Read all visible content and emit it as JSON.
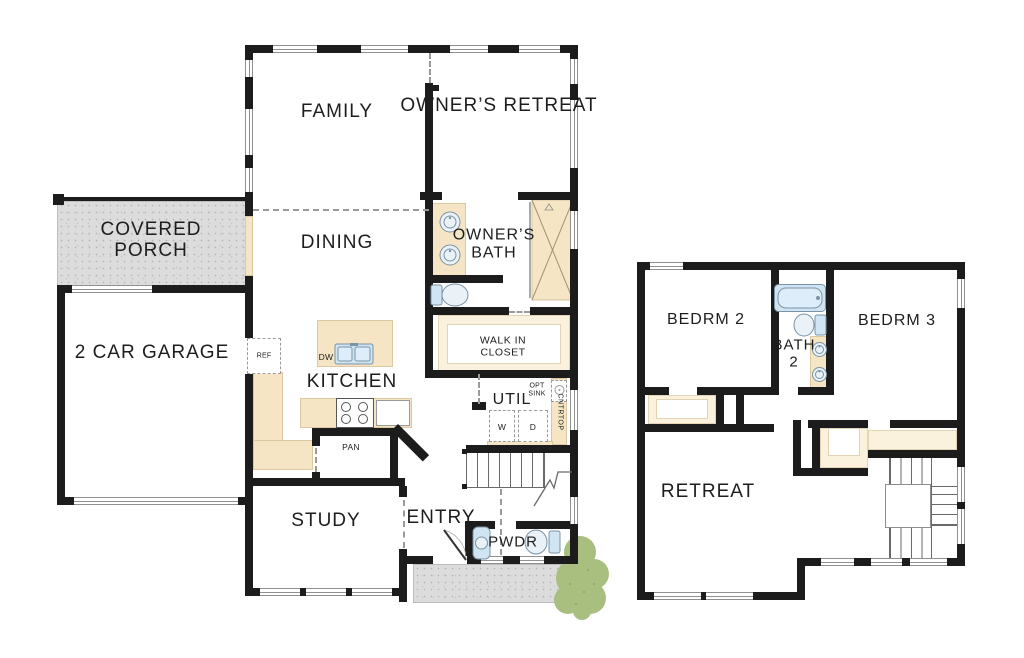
{
  "plan_type": "two-story-floor-plan",
  "colors": {
    "wall": "#1c1c1c",
    "counter_tan": "#f5e5c4",
    "closet_tan": "#fbf2dd",
    "porch_gray": "#dcdcdc",
    "porch_dot": "#b5b5b5",
    "fixture_blue": "#cfe5f3",
    "fixture_stroke": "#7b93a4",
    "bush_green": "#a9bf80",
    "bush_dot": "#8ba368",
    "line_gray": "#909090",
    "text": "#1d1d1d"
  },
  "first_floor": {
    "labels": {
      "family": "FAMILY",
      "owners_retreat": "OWNER’S RETREAT",
      "covered_porch_line1": "COVERED",
      "covered_porch_line2": "PORCH",
      "dining": "DINING",
      "garage": "2 CAR GARAGE",
      "owners_bath_line1": "OWNER’S",
      "owners_bath_line2": "BATH",
      "kitchen": "KITCHEN",
      "ref": "REF",
      "dw": "DW",
      "pan": "PAN",
      "walk_in_closet_line1": "WALK IN",
      "walk_in_closet_line2": "CLOSET",
      "util": "UTIL",
      "opt_sink_line1": "OPT",
      "opt_sink_line2": "SINK",
      "cntrtop": "CNTRTOP",
      "washer": "W",
      "dryer": "D",
      "study": "STUDY",
      "entry": "ENTRY",
      "pwdr": "PWDR"
    }
  },
  "second_floor": {
    "labels": {
      "bedrm2": "BEDRM 2",
      "bath2_line1": "BATH",
      "bath2_line2": "2",
      "bedrm3": "BEDRM 3",
      "retreat": "RETREAT"
    }
  }
}
